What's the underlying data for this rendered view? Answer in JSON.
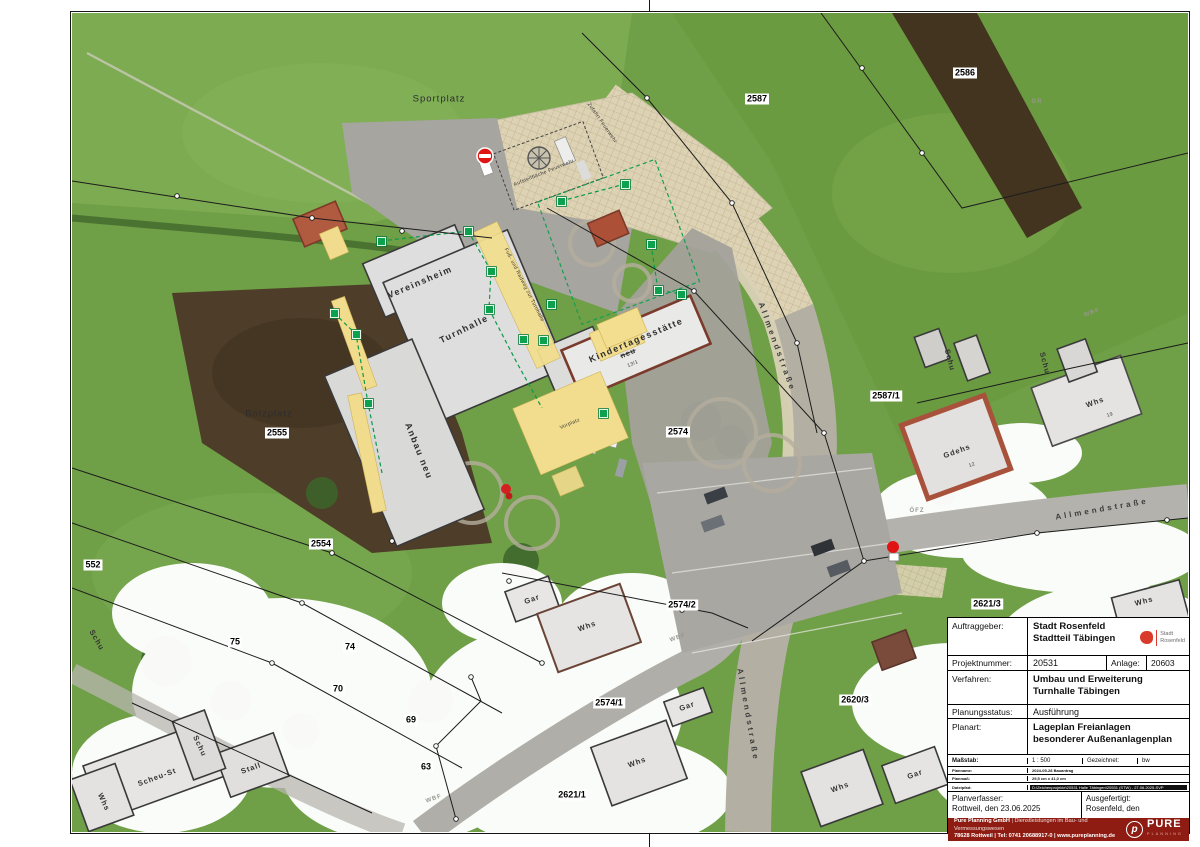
{
  "titleblock": {
    "auftraggeber_label": "Auftraggeber:",
    "auftraggeber_line1": "Stadt Rosenfeld",
    "auftraggeber_line2": "Stadtteil Täbingen",
    "stadt_logo_line1": "Stadt",
    "stadt_logo_line2": "Rosenfeld",
    "projektnummer_label": "Projektnummer:",
    "projektnummer_value": "20531",
    "anlage_label": "Anlage:",
    "anlage_value": "20603",
    "verfahren_label": "Verfahren:",
    "verfahren_line1": "Umbau und Erweiterung",
    "verfahren_line2": "Turnhalle Täbingen",
    "planungsstatus_label": "Planungsstatus:",
    "planungsstatus_value": "Ausführung",
    "planart_label": "Planart:",
    "planart_line1": "Lageplan Freianlagen",
    "planart_line2": "besonderer Außenanlagenplan",
    "massstab_label": "Maßstab:",
    "massstab_value": "1 : 500",
    "gezeichnet_label": "Gezeichnet:",
    "gezeichnet_value": "bw",
    "planname_label": "Planname:",
    "planname_value": "2024-05-28 Bauantrag",
    "planmass_label": "Planmaß:",
    "planmass_value": "29,5 cm x 41,0 cm",
    "dateipfad_label": "Dateipfad:",
    "dateipfad_value": "D:\\Zeichenprojekte\\20531 Halle Täbingen\\20531 (STW) - 27.06.2025-SVP",
    "planverfasser_label": "Planverfasser:",
    "planverfasser_value": "Rottweil, den 23.06.2025",
    "ausgefertigt_label": "Ausgefertigt:",
    "ausgefertigt_value": "Rosenfeld, den",
    "footer_name": "Pure Planning GmbH",
    "footer_services": "| Dienstleistungen im Bau- und Vermessungswesen",
    "footer_contact": "78628 Rottweil | Tel: 0741 20688917-0 | www.pureplanning.de",
    "footer_logo_p": "p",
    "footer_logo_word": "PURE",
    "footer_logo_sub": "PLANNING"
  },
  "map": {
    "labels": [
      {
        "t": "Sportplatz",
        "x": 367,
        "y": 86,
        "cls": "area",
        "rot": 0,
        "n": "label-sportplatz"
      },
      {
        "t": "Bolzplatz",
        "x": 197,
        "y": 401,
        "cls": "area",
        "rot": 0,
        "n": "label-bolzplatz"
      },
      {
        "t": "2587",
        "x": 685,
        "y": 86,
        "cls": "parcel",
        "rot": 0,
        "n": "parcel-2587"
      },
      {
        "t": "2586",
        "x": 893,
        "y": 60,
        "cls": "parcel",
        "rot": 0,
        "n": "parcel-2586"
      },
      {
        "t": "2587/1",
        "x": 814,
        "y": 383,
        "cls": "parcel",
        "rot": 0,
        "n": "parcel-2587-1"
      },
      {
        "t": "2555",
        "x": 205,
        "y": 420,
        "cls": "parcel",
        "rot": 0,
        "n": "parcel-2555"
      },
      {
        "t": "2554",
        "x": 249,
        "y": 531,
        "cls": "parcel",
        "rot": 0,
        "n": "parcel-2554"
      },
      {
        "t": "552",
        "x": 21,
        "y": 552,
        "cls": "parcel",
        "rot": 0,
        "n": "parcel-552"
      },
      {
        "t": "75",
        "x": 163,
        "y": 629,
        "cls": "parcel",
        "rot": 0,
        "n": "parcel-75"
      },
      {
        "t": "74",
        "x": 278,
        "y": 634,
        "cls": "parcel",
        "rot": 0,
        "n": "parcel-74"
      },
      {
        "t": "70",
        "x": 266,
        "y": 676,
        "cls": "parcel",
        "rot": 0,
        "n": "parcel-70"
      },
      {
        "t": "69",
        "x": 339,
        "y": 707,
        "cls": "parcel",
        "rot": 0,
        "n": "parcel-69"
      },
      {
        "t": "63",
        "x": 354,
        "y": 754,
        "cls": "parcel",
        "rot": 0,
        "n": "parcel-63"
      },
      {
        "t": "2574",
        "x": 606,
        "y": 419,
        "cls": "parcel",
        "rot": 0,
        "n": "parcel-2574"
      },
      {
        "t": "2574/2",
        "x": 610,
        "y": 592,
        "cls": "parcel",
        "rot": 0,
        "n": "parcel-2574-2"
      },
      {
        "t": "2574/1",
        "x": 537,
        "y": 690,
        "cls": "parcel",
        "rot": 0,
        "n": "parcel-2574-1"
      },
      {
        "t": "2621/1",
        "x": 500,
        "y": 782,
        "cls": "parcel",
        "rot": 0,
        "n": "parcel-2621-1"
      },
      {
        "t": "2620/3",
        "x": 783,
        "y": 687,
        "cls": "parcel",
        "rot": 0,
        "n": "parcel-2620-3"
      },
      {
        "t": "2621/3",
        "x": 915,
        "y": 591,
        "cls": "parcel",
        "rot": 0,
        "n": "parcel-2621-3"
      },
      {
        "t": "Vereinsheim",
        "x": 348,
        "y": 269,
        "cls": "bldg-lg",
        "rot": -23,
        "n": "label-vereinsheim"
      },
      {
        "t": "Turnhalle",
        "x": 392,
        "y": 316,
        "cls": "bldg-lg",
        "rot": -26,
        "n": "label-turnhalle"
      },
      {
        "t": "Anbau neu",
        "x": 347,
        "y": 438,
        "cls": "bldg-lg",
        "rot": 68,
        "n": "label-anbau-neu"
      },
      {
        "t": "Kindertagesstätte",
        "x": 564,
        "y": 327,
        "cls": "bldg-lg",
        "rot": -23,
        "n": "label-kindertagesstaette"
      },
      {
        "t": "neu",
        "x": 556,
        "y": 340,
        "cls": "bldg strike",
        "rot": -23,
        "n": "label-kita-neu"
      },
      {
        "t": "13/1",
        "x": 561,
        "y": 351,
        "cls": "tiny",
        "rot": -23,
        "n": "label-13-1"
      },
      {
        "t": "Vorplatz",
        "x": 498,
        "y": 411,
        "cls": "tiny",
        "rot": -23,
        "n": "label-vorplatz"
      },
      {
        "t": "Gar",
        "x": 460,
        "y": 586,
        "cls": "bldg",
        "rot": -20,
        "n": "label-gar-1"
      },
      {
        "t": "Whs",
        "x": 515,
        "y": 613,
        "cls": "bldg",
        "rot": -20,
        "n": "label-whs-1"
      },
      {
        "t": "Gar",
        "x": 615,
        "y": 693,
        "cls": "bldg",
        "rot": -20,
        "n": "label-gar-2"
      },
      {
        "t": "Whs",
        "x": 565,
        "y": 749,
        "cls": "bldg",
        "rot": -20,
        "n": "label-whs-2"
      },
      {
        "t": "Whs",
        "x": 32,
        "y": 789,
        "cls": "bldg",
        "rot": 65,
        "n": "label-whs-3"
      },
      {
        "t": "Scheu-St",
        "x": 85,
        "y": 764,
        "cls": "bldg",
        "rot": -20,
        "n": "label-scheu-st"
      },
      {
        "t": "Schu",
        "x": 128,
        "y": 733,
        "cls": "bldg",
        "rot": 65,
        "n": "label-schu-1"
      },
      {
        "t": "Stall",
        "x": 179,
        "y": 755,
        "cls": "bldg",
        "rot": -20,
        "n": "label-stall"
      },
      {
        "t": "Schu",
        "x": 25,
        "y": 627,
        "cls": "bldg",
        "rot": 60,
        "n": "label-schu-2"
      },
      {
        "t": "Gdehs",
        "x": 885,
        "y": 438,
        "cls": "bldg",
        "rot": -20,
        "n": "label-gdehs"
      },
      {
        "t": "12",
        "x": 900,
        "y": 452,
        "cls": "tiny",
        "rot": -20,
        "n": "label-12"
      },
      {
        "t": "Whs",
        "x": 1023,
        "y": 389,
        "cls": "bldg",
        "rot": -20,
        "n": "label-whs-4"
      },
      {
        "t": "19",
        "x": 1038,
        "y": 402,
        "cls": "tiny",
        "rot": -20,
        "n": "label-19"
      },
      {
        "t": "Schu",
        "x": 878,
        "y": 347,
        "cls": "bldg",
        "rot": 75,
        "n": "label-schu-3"
      },
      {
        "t": "Schu",
        "x": 973,
        "y": 350,
        "cls": "bldg",
        "rot": 75,
        "n": "label-schu-4"
      },
      {
        "t": "Whs",
        "x": 1072,
        "y": 588,
        "cls": "bldg",
        "rot": -15,
        "n": "label-whs-5"
      },
      {
        "t": "Gar",
        "x": 843,
        "y": 761,
        "cls": "bldg",
        "rot": -20,
        "n": "label-gar-3"
      },
      {
        "t": "Whs",
        "x": 768,
        "y": 774,
        "cls": "bldg",
        "rot": -20,
        "n": "label-whs-6"
      },
      {
        "t": "Allmendstraße",
        "x": 705,
        "y": 334,
        "cls": "street",
        "rot": 70,
        "n": "label-allmendstrasse-1"
      },
      {
        "t": "Allmendstraße",
        "x": 676,
        "y": 702,
        "cls": "street",
        "rot": 80,
        "n": "label-allmendstrasse-2"
      },
      {
        "t": "Allmendstraße",
        "x": 1030,
        "y": 496,
        "cls": "street",
        "rot": -10,
        "n": "label-allmendstrasse-3"
      },
      {
        "t": "Zufahrt Feuerwehr",
        "x": 530,
        "y": 110,
        "cls": "tiny",
        "rot": 55,
        "n": "label-zufahrt-feuerwehr"
      },
      {
        "t": "Aufstellfläche Feuerwehr",
        "x": 472,
        "y": 160,
        "cls": "tiny",
        "rot": -22,
        "n": "label-aufstellflaeche"
      },
      {
        "t": "Fuß- und Radweg zur Turnhalle",
        "x": 452,
        "y": 272,
        "cls": "tiny",
        "rot": 63,
        "n": "label-fussweg"
      },
      {
        "t": "GR",
        "x": 965,
        "y": 89,
        "cls": "code",
        "rot": 0,
        "n": "code-gr"
      },
      {
        "t": "WBF",
        "x": 1020,
        "y": 300,
        "cls": "code",
        "rot": -20,
        "n": "code-wbf-1"
      },
      {
        "t": "WBF",
        "x": 606,
        "y": 625,
        "cls": "code",
        "rot": -20,
        "n": "code-wbf-2"
      },
      {
        "t": "WBF",
        "x": 362,
        "y": 786,
        "cls": "code",
        "rot": -20,
        "n": "code-wbf-3"
      },
      {
        "t": "ÖFZ",
        "x": 845,
        "y": 498,
        "cls": "code",
        "rot": 0,
        "n": "code-oefz"
      }
    ],
    "markers": [
      [
        309,
        228
      ],
      [
        396,
        218
      ],
      [
        419,
        258
      ],
      [
        417,
        296
      ],
      [
        284,
        321
      ],
      [
        262,
        300
      ],
      [
        296,
        390
      ],
      [
        479,
        291
      ],
      [
        451,
        326
      ],
      [
        471,
        327
      ],
      [
        553,
        171
      ],
      [
        579,
        231
      ],
      [
        586,
        277
      ],
      [
        609,
        281
      ],
      [
        489,
        188
      ],
      [
        531,
        400
      ]
    ]
  }
}
